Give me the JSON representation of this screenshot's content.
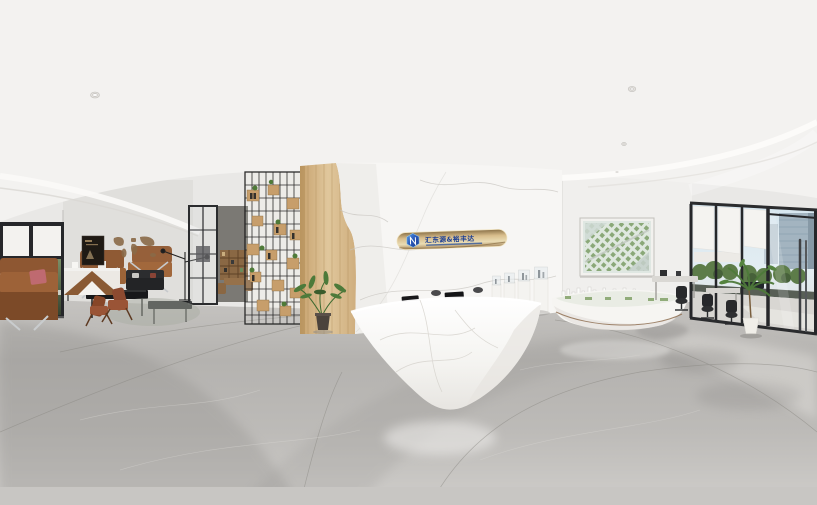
{
  "scene": {
    "description": "360-degree panoramic render of a real-estate sales center lobby",
    "areas": [
      "lounge",
      "reception",
      "model-display",
      "entrance-glazing",
      "office-workstations"
    ]
  },
  "signage": {
    "name": "汇东源&裕丰达",
    "logo": "blue-hexagon-monogram"
  },
  "artwork": {
    "masterplan_painting": "aerial masterplan rendering",
    "world_map": "bronze world map wall art",
    "poster": "dark vintage poster"
  },
  "palette": {
    "ceiling": "#f3f2f0",
    "wall": "#e9e8e6",
    "marble": "#f7f6f4",
    "wood": "#d9bd8f",
    "gold": "#c9ad7e",
    "logo_blue": "#2857b8",
    "floor": "#b9b7b4",
    "leather": "#95613a",
    "foliage": "#567a42",
    "frame_black": "#26272a"
  }
}
